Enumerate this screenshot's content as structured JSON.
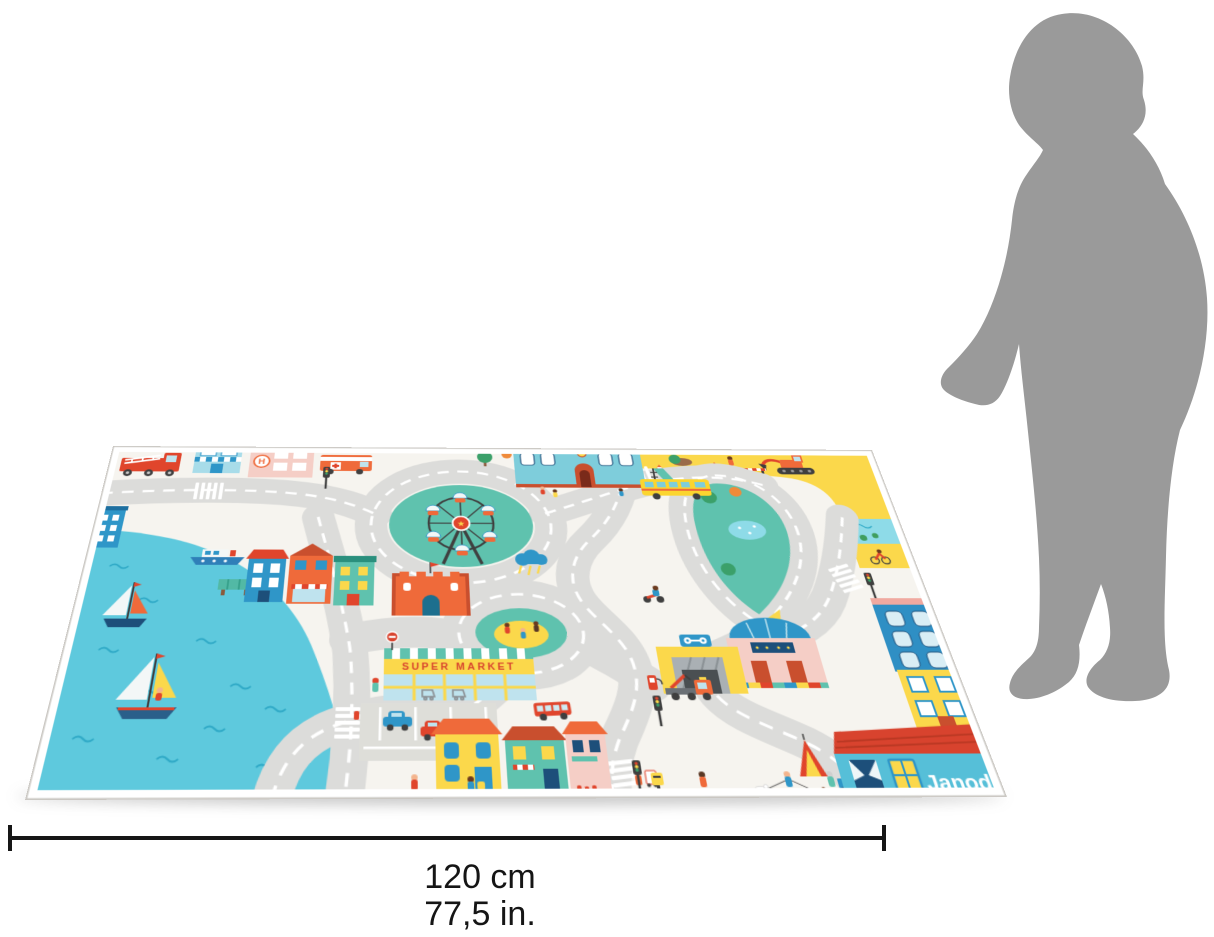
{
  "scene": {
    "type": "product-dimension-photo",
    "product": "city road play mat",
    "brand": {
      "logo_text": "Janod",
      "registered_mark": "®"
    },
    "mat_texts": {
      "supermarket_sign": "SUPER MARKET",
      "hospital_sign": "H"
    },
    "dimension_label": {
      "cm": "120 cm",
      "inches": "77,5 in."
    },
    "scale_reference": "child silhouette",
    "colors": {
      "mat_base": "#f6f4ef",
      "road": "#dcdcda",
      "road_dash": "#ffffff",
      "water": "#5ec9dd",
      "grass_green": "#5fc2ae",
      "construction_yellow": "#fbd84b",
      "orange_red": "#e8532f",
      "building_blue": "#2f96c8",
      "light_blue": "#a8dce9",
      "pink": "#f5cec6",
      "silhouette_gray": "#9a9a9a",
      "dimension_line": "#161616"
    }
  }
}
